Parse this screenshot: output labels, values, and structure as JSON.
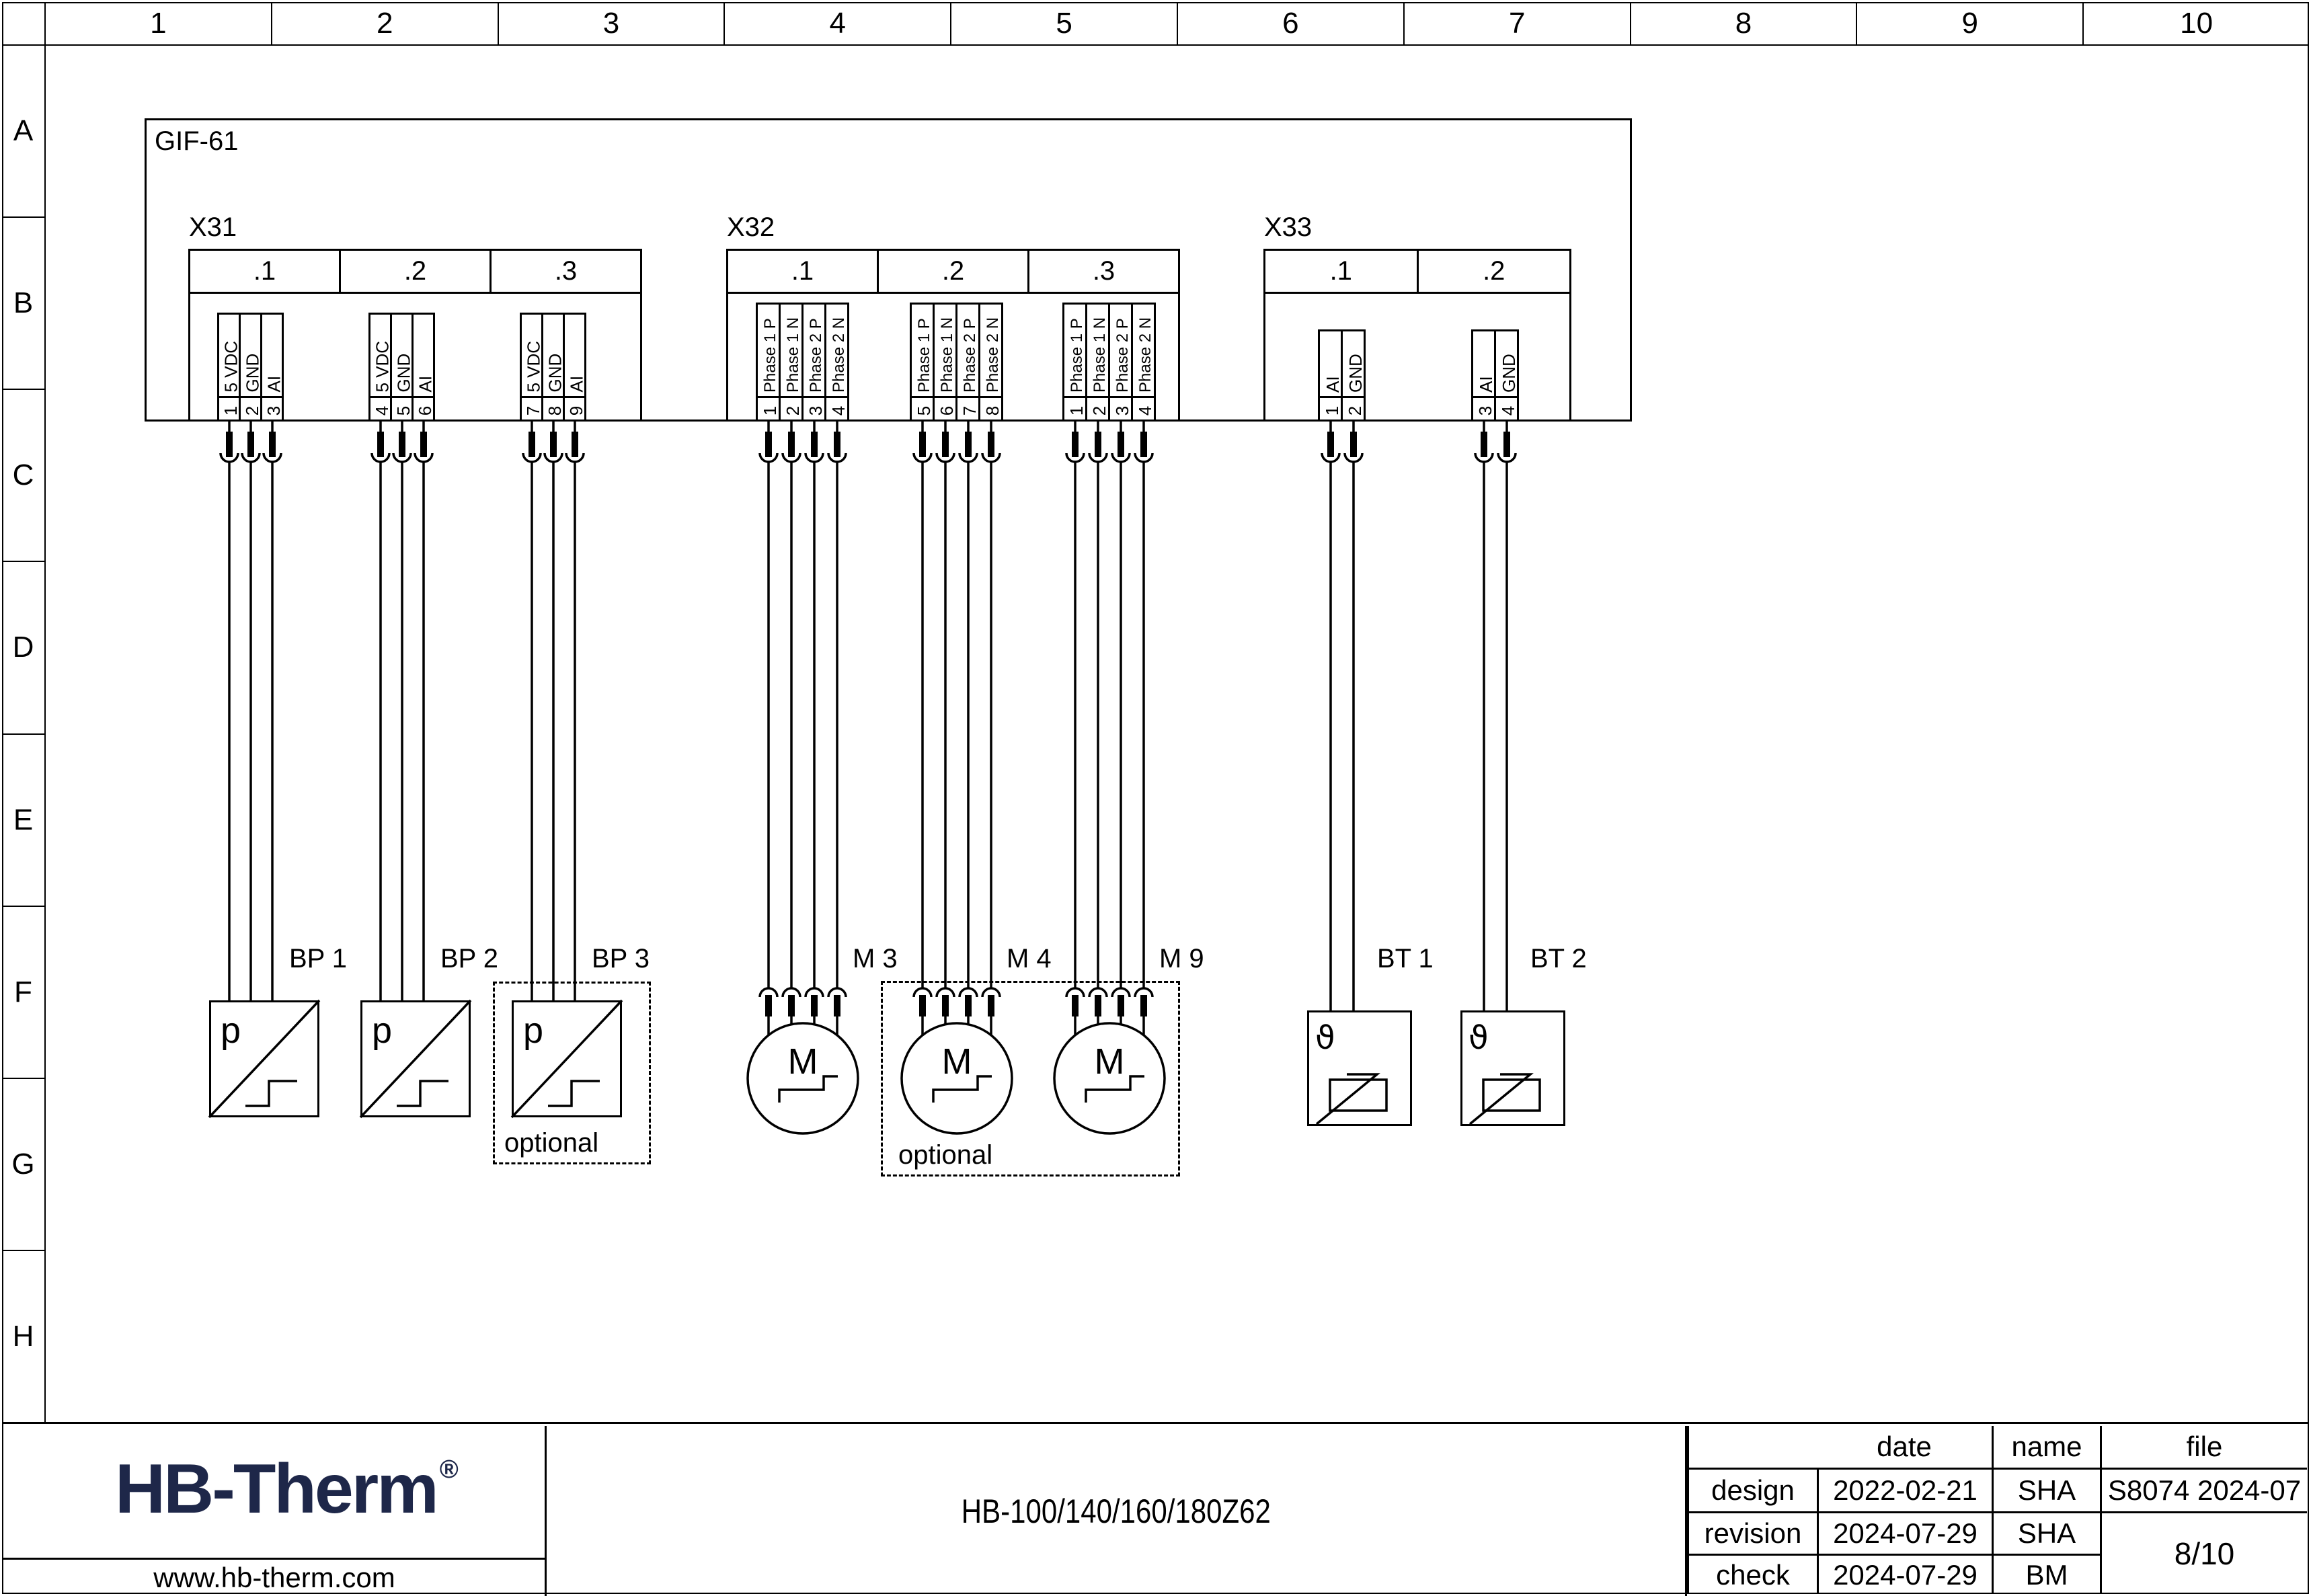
{
  "sheet": {
    "columns": [
      "1",
      "2",
      "3",
      "4",
      "5",
      "6",
      "7",
      "8",
      "9",
      "10"
    ],
    "rows": [
      "A",
      "B",
      "C",
      "D",
      "E",
      "F",
      "G",
      "H"
    ]
  },
  "colors": {
    "line": "#000000",
    "background": "#ffffff",
    "logo": "#1e2749"
  },
  "device": {
    "label": "GIF-61",
    "connectors": [
      {
        "name": "X31",
        "sections": [
          {
            "label": ".1",
            "pins": [
              {
                "n": "1",
                "signal": "5 VDC"
              },
              {
                "n": "2",
                "signal": "GND"
              },
              {
                "n": "3",
                "signal": "AI"
              }
            ]
          },
          {
            "label": ".2",
            "pins": [
              {
                "n": "4",
                "signal": "5 VDC"
              },
              {
                "n": "5",
                "signal": "GND"
              },
              {
                "n": "6",
                "signal": "AI"
              }
            ]
          },
          {
            "label": ".3",
            "pins": [
              {
                "n": "7",
                "signal": "5 VDC"
              },
              {
                "n": "8",
                "signal": "GND"
              },
              {
                "n": "9",
                "signal": "AI"
              }
            ]
          }
        ]
      },
      {
        "name": "X32",
        "sections": [
          {
            "label": ".1",
            "pins": [
              {
                "n": "1",
                "signal": "Phase 1 P"
              },
              {
                "n": "2",
                "signal": "Phase 1 N"
              },
              {
                "n": "3",
                "signal": "Phase 2 P"
              },
              {
                "n": "4",
                "signal": "Phase 2 N"
              }
            ]
          },
          {
            "label": ".2",
            "pins": [
              {
                "n": "5",
                "signal": "Phase 1 P"
              },
              {
                "n": "6",
                "signal": "Phase 1 N"
              },
              {
                "n": "7",
                "signal": "Phase 2 P"
              },
              {
                "n": "8",
                "signal": "Phase 2 N"
              }
            ]
          },
          {
            "label": ".3",
            "pins": [
              {
                "n": "1",
                "signal": "Phase 1 P"
              },
              {
                "n": "2",
                "signal": "Phase 1 N"
              },
              {
                "n": "3",
                "signal": "Phase 2 P"
              },
              {
                "n": "4",
                "signal": "Phase 2 N"
              }
            ]
          }
        ]
      },
      {
        "name": "X33",
        "sections": [
          {
            "label": ".1",
            "pins": [
              {
                "n": "1",
                "signal": "AI"
              },
              {
                "n": "2",
                "signal": "GND"
              }
            ]
          },
          {
            "label": ".2",
            "pins": [
              {
                "n": "3",
                "signal": "AI"
              },
              {
                "n": "4",
                "signal": "GND"
              }
            ]
          }
        ]
      }
    ]
  },
  "components": {
    "pressure_symbol": "p",
    "motor_symbol": "M",
    "temperature_symbol": "ϑ",
    "bp1": "BP 1",
    "bp2": "BP 2",
    "bp3": "BP 3",
    "m3": "M 3",
    "m4": "M 4",
    "m9": "M 9",
    "bt1": "BT 1",
    "bt2": "BT 2",
    "optional": "optional"
  },
  "titleblock": {
    "logo_text": "HB-Therm",
    "logo_reg": "®",
    "website": "www.hb-therm.com",
    "doc_title": "HB-100/140/160/180Z62",
    "headers": {
      "date": "date",
      "name": "name",
      "file": "file"
    },
    "rows": [
      {
        "label": "design",
        "date": "2022-02-21",
        "name": "SHA"
      },
      {
        "label": "revision",
        "date": "2024-07-29",
        "name": "SHA"
      },
      {
        "label": "check",
        "date": "2024-07-29",
        "name": "BM"
      }
    ],
    "file_no": "S8074 2024-07",
    "page": "8/10"
  }
}
